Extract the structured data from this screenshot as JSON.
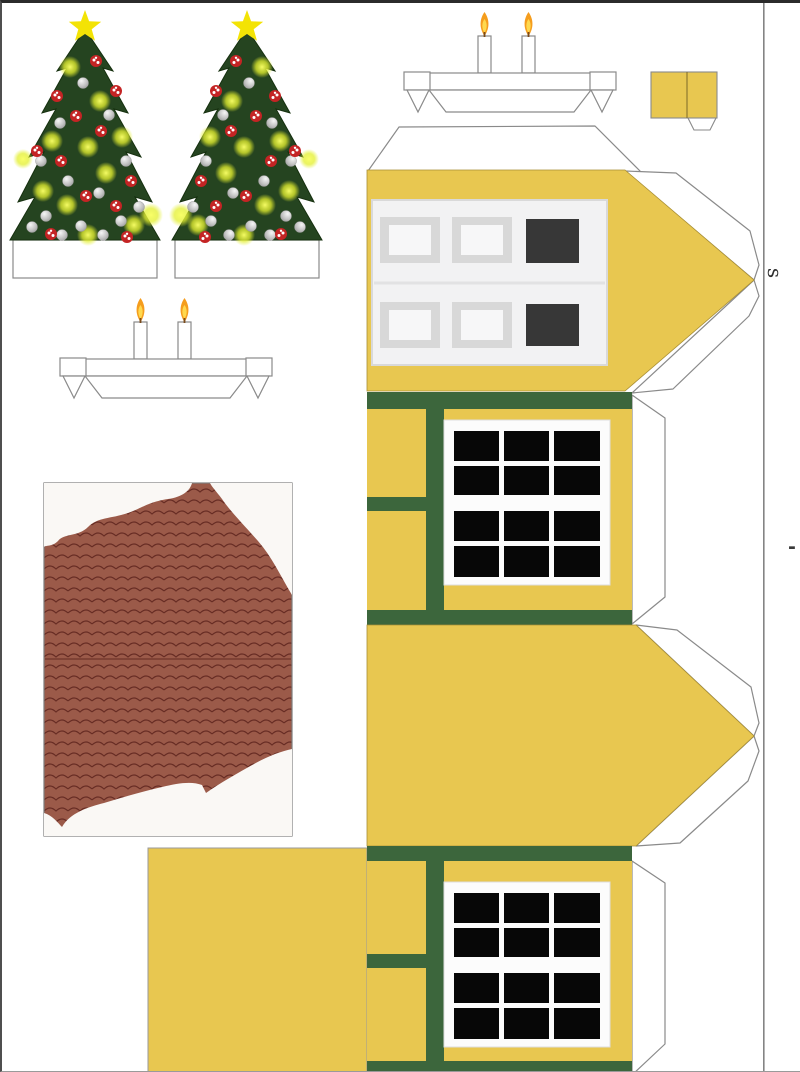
{
  "annotations": {
    "side_letter": "s",
    "edge_dash": "-"
  },
  "colors": {
    "wall_yellow": "#e8c750",
    "yellow_edge": "#a98f35",
    "trim_green": "#3c663c",
    "pane_black": "#070707",
    "door_dark": "#373737",
    "panel_light": "#f2f2f3",
    "panel_frame": "#d8d8d8",
    "panel_inner": "#f7f7f8",
    "window_white": "#fcfcfc",
    "roof_brown": "#9b5a49",
    "roof_line": "#5e241d",
    "snow_white": "#faf8f5",
    "tree_green": "#254420",
    "tree_edge": "#16300f",
    "star_yellow": "#f3e305",
    "candy_red": "#c42424",
    "flame_orange": "#f59d1d",
    "flame_yellow": "#ffd94e",
    "outline_gray": "#8a8a8a",
    "tab_white": "#ffffff",
    "margin_line": "#6e6e6e"
  },
  "pieces": {
    "tree_count": 2,
    "candle_holder_count": 2,
    "candles_per_holder": 2,
    "chimney_segments": 2,
    "window_grid": {
      "cols": 3,
      "rows": 4
    },
    "door_grid": {
      "cols": 3,
      "rows": 2
    },
    "windows_count": 2,
    "gable_ends": 2
  }
}
